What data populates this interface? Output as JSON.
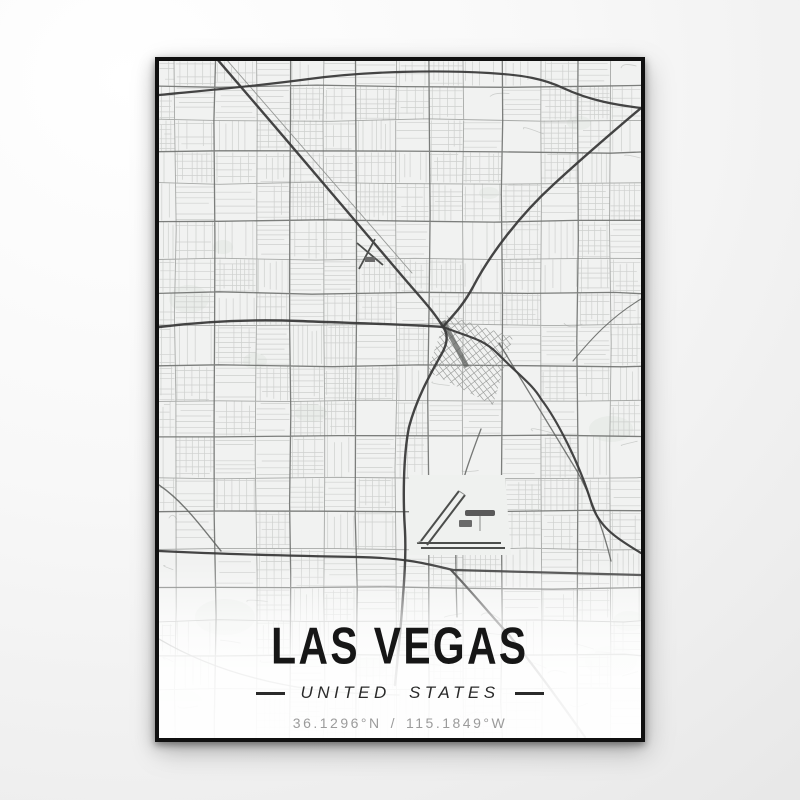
{
  "poster": {
    "title": "LAS VEGAS",
    "subtitle": "UNITED STATES",
    "coordinates": {
      "lat": "36.1296°N",
      "separator": "/",
      "lon": "115.1849°W"
    }
  },
  "map": {
    "region_label": "Las Vegas metropolitan street grid",
    "colors": {
      "paper": "#f1f2f1",
      "fine_street": "#c8cac8",
      "minor_arterial": "#9a9c9a",
      "major_arterial": "#6f716f",
      "highway": "#3a3a3a",
      "secondary": "#5f615f",
      "rail": "#8c8e8c",
      "park": "#e8ebe8",
      "airfield": "#eff1ef",
      "runway": "#4c4e4c",
      "frame": "#101010",
      "title_text": "#161616",
      "subtitle_text": "#2a2a2a",
      "coords_text": "#9b9b9b"
    },
    "features": [
      {
        "name": "beltway-north",
        "tier": "freeway",
        "width": 2.2,
        "d": "M0,34 C40,30 90,26 150,18 C210,10 280,9 330,12 C365,14 385,18 404,27 C432,40 458,44 482,47"
      },
      {
        "name": "us95-northwest-freeway",
        "tier": "freeway",
        "width": 2.4,
        "d": "M58,-2 C120,70 200,164 244,216 C262,237 276,252 284,266"
      },
      {
        "name": "i15-northeast-freeway",
        "tier": "freeway",
        "width": 2.4,
        "d": "M482,47 C450,74 420,100 394,124 C360,155 330,195 314,226 C302,248 292,256 284,266"
      },
      {
        "name": "us95-west-freeway",
        "tier": "freeway",
        "width": 2.4,
        "d": "M0,266 C40,261 90,258 140,260 C190,262 240,263 284,266"
      },
      {
        "name": "i15-south-freeway",
        "tier": "freeway",
        "width": 2.4,
        "d": "M284,266 C290,274 288,284 282,294 C272,312 258,336 250,366 C244,396 244,440 246,470 C247,490 246,510 244,535 C242,565 239,595 236,624"
      },
      {
        "name": "i515-southeast-freeway",
        "tier": "freeway",
        "width": 2.2,
        "d": "M284,266 C310,276 324,278 338,292 C362,316 374,324 382,338 C396,356 420,400 433,444 C441,468 462,480 482,492"
      },
      {
        "name": "beltway-south",
        "tier": "freeway",
        "width": 2.2,
        "d": "M0,490 C60,493 140,495 200,496 C250,497 272,504 294,509 L482,514"
      },
      {
        "name": "i215-southeast-leg",
        "tier": "freeway",
        "width": 2.2,
        "d": "M292,509 C312,530 330,552 350,574 C376,606 402,642 426,676"
      },
      {
        "name": "boulder-highway",
        "tier": "secondary",
        "width": 1.3,
        "d": "M340,282 L418,410 C430,432 444,466 452,500"
      },
      {
        "name": "las-vegas-blvd-strip",
        "tier": "secondary",
        "width": 1.3,
        "d": "M322,368 C310,400 301,424 298,450 C296,480 297,520 298,556"
      },
      {
        "name": "northwest-railroad",
        "tier": "rail",
        "width": 0.9,
        "d": "M67,-2 L253,212"
      },
      {
        "name": "summerlin-west-curve",
        "tier": "secondary",
        "width": 1.4,
        "d": "M0,424 C24,440 44,468 62,490"
      },
      {
        "name": "southwest-suburb-curve",
        "tier": "secondary",
        "width": 1.3,
        "d": "M0,578 C44,604 96,620 150,628 C180,632 210,633 240,634"
      },
      {
        "name": "northeast-connector",
        "tier": "secondary",
        "width": 1.1,
        "d": "M482,238 C452,256 432,278 414,300"
      }
    ],
    "parks": [
      [
        30,
        238,
        20,
        14
      ],
      [
        64,
        186,
        10,
        7
      ],
      [
        152,
        352,
        16,
        9
      ],
      [
        452,
        368,
        22,
        13
      ],
      [
        452,
        600,
        26,
        15
      ],
      [
        66,
        556,
        30,
        18
      ],
      [
        210,
        606,
        18,
        10
      ],
      [
        420,
        62,
        12,
        7
      ],
      [
        330,
        132,
        10,
        6
      ],
      [
        96,
        300,
        12,
        8
      ],
      [
        20,
        642,
        24,
        14
      ],
      [
        470,
        560,
        16,
        10
      ]
    ],
    "airports": [
      {
        "name": "harry-reid-international-airport"
      },
      {
        "name": "north-las-vegas-airport"
      }
    ],
    "districts": [
      {
        "name": "downtown-rotated-grid"
      }
    ]
  }
}
